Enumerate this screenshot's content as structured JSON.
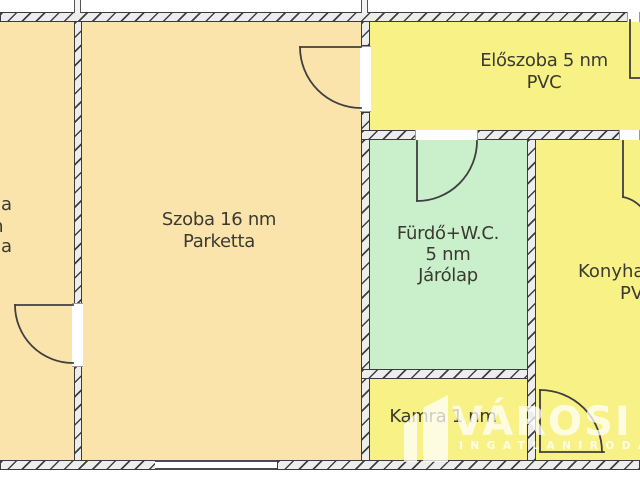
{
  "plan": {
    "left_room_fragments": {
      "f1": "a",
      "f2": "m",
      "f3": "a"
    },
    "szoba": {
      "name_line": "Szoba 16 nm",
      "floor_line": "Parketta"
    },
    "eloszoba": {
      "name_line": "Előszoba 5 nm",
      "floor_line": "PVC"
    },
    "furdo": {
      "name_line": "Fürdő+W.C.",
      "area_line": "5 nm",
      "floor_line": "Járólap"
    },
    "konyha": {
      "name_line": "Konyha",
      "floor_line": "PVC"
    },
    "kamra": {
      "name_line": "Kamra 1 nm"
    }
  },
  "watermark": {
    "brand": "VÁROSI",
    "subtitle": "INGATLANIRODA"
  },
  "colors": {
    "room_cream": "#fbe4ab",
    "room_yellow": "#f8f286",
    "room_green": "#c9efcb",
    "wall_line": "#3b3b3b",
    "wall_fill": "#ededed",
    "label_text": "#3a3a32",
    "watermark_white": "#ffffff"
  }
}
